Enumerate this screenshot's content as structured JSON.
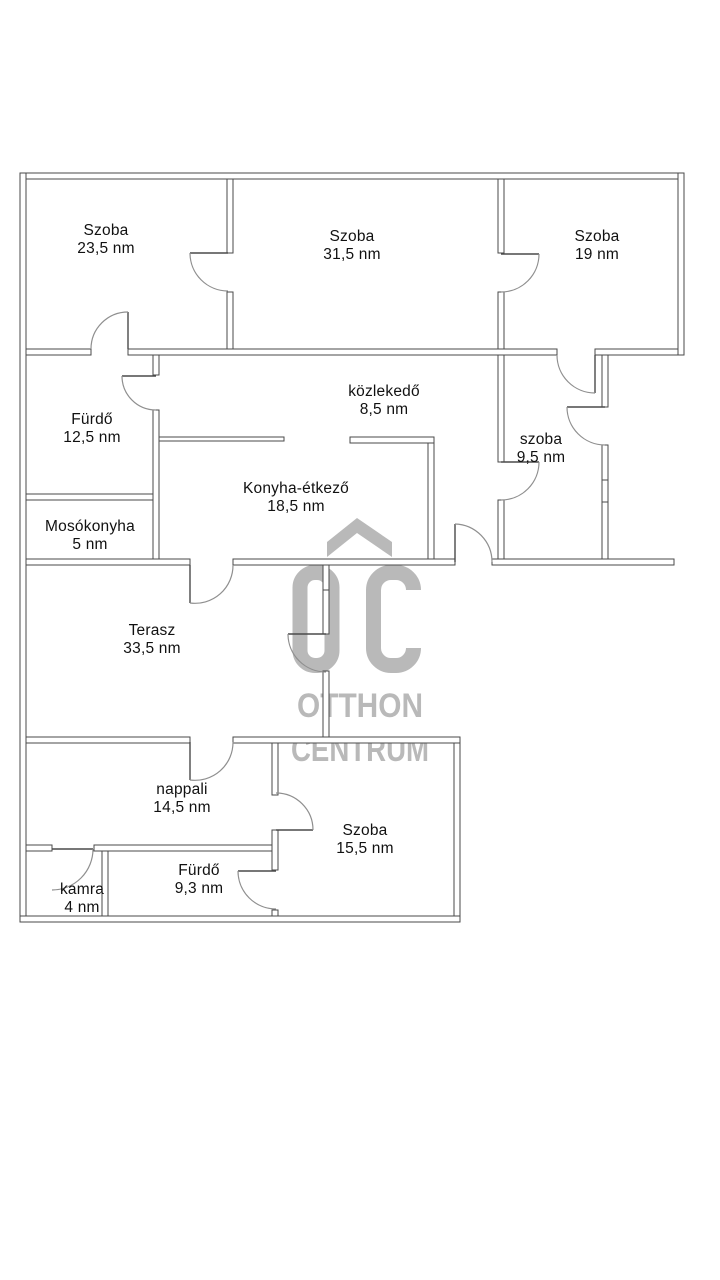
{
  "watermark": {
    "logo_monogram": "OC",
    "roof_icon": "house-roof-chevron",
    "line1": "OTTHON",
    "line2": "CENTRUM"
  },
  "colors": {
    "wall-line": "#4a4a4a",
    "door-arc": "#8f8f8f",
    "watermark": "#b9b9b9",
    "label-ink": "#111111",
    "paper": "#ffffff"
  },
  "rooms": [
    {
      "name": "Szoba",
      "area": "23,5 nm"
    },
    {
      "name": "Szoba",
      "area": "31,5 nm"
    },
    {
      "name": "Szoba",
      "area": "19 nm"
    },
    {
      "name": "közlekedő",
      "area": "8,5 nm"
    },
    {
      "name": "Fürdő",
      "area": "12,5 nm"
    },
    {
      "name": "szoba",
      "area": "9,5 nm"
    },
    {
      "name": "Konyha-étkező",
      "area": "18,5 nm"
    },
    {
      "name": "Mosókonyha",
      "area": "5 nm"
    },
    {
      "name": "Terasz",
      "area": "33,5 nm"
    },
    {
      "name": "nappali",
      "area": "14,5 nm"
    },
    {
      "name": "Szoba",
      "area": "15,5 nm"
    },
    {
      "name": "Fürdő",
      "area": "9,3 nm"
    },
    {
      "name": "kamra",
      "area": "4 nm"
    }
  ]
}
